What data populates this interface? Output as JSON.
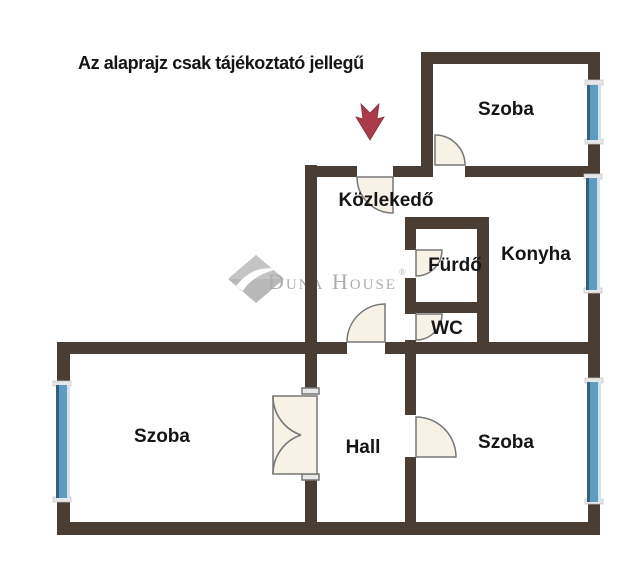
{
  "disclaimer": {
    "text": "Az alaprajz csak tájékoztató jellegű"
  },
  "rooms": {
    "szoba_top_right": {
      "label": "Szoba"
    },
    "kozlekedo": {
      "label": "Közlekedő"
    },
    "furdo": {
      "label": "Fürdő"
    },
    "konyha": {
      "label": "Konyha"
    },
    "wc": {
      "label": "WC"
    },
    "szoba_left": {
      "label": "Szoba"
    },
    "hall": {
      "label": "Hall"
    },
    "szoba_right": {
      "label": "Szoba"
    }
  },
  "watermark": {
    "text": "Duna House",
    "registered_mark": "®"
  },
  "colors": {
    "background": "#ffffff",
    "wall": "#4a3d33",
    "window_glass": "#5e9dbf",
    "window_frame_dark": "#35607c",
    "window_frame_light": "#cfe2ed",
    "window_cap": "#e6e6e6",
    "door_fill": "#f8f1e6",
    "door_stroke": "#777777",
    "label_text": "#151515",
    "watermark_gray": "#a7a7a7",
    "arrow_red": "#a93b4a"
  }
}
